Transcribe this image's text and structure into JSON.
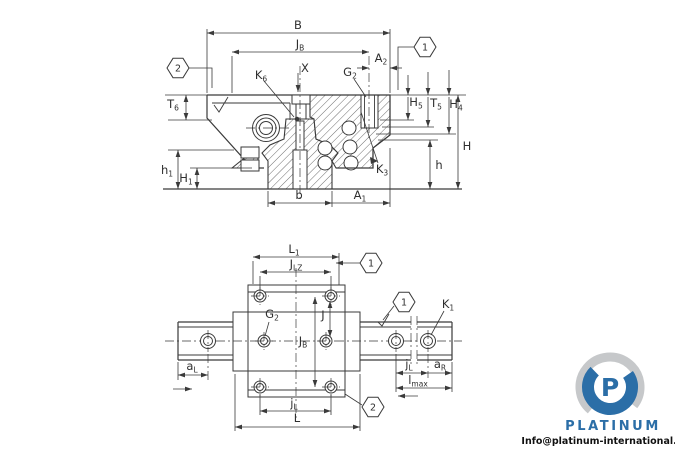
{
  "colors": {
    "line": "#3a3a3a",
    "text": "#2f2f2f",
    "logo_blue": "#2b6ea7",
    "logo_gray": "#c6c8ca"
  },
  "section_view": {
    "dims": {
      "B": {
        "main": "B",
        "sub": ""
      },
      "JB": {
        "main": "J",
        "sub": "B"
      },
      "A2": {
        "main": "A",
        "sub": "2"
      },
      "K6": {
        "main": "K",
        "sub": "6"
      },
      "X": {
        "main": "X",
        "sub": ""
      },
      "G2": {
        "main": "G",
        "sub": "2"
      },
      "T6": {
        "main": "T",
        "sub": "6"
      },
      "H5": {
        "main": "H",
        "sub": "5"
      },
      "T5": {
        "main": "T",
        "sub": "5"
      },
      "H4": {
        "main": "H",
        "sub": "4"
      },
      "H": {
        "main": "H",
        "sub": ""
      },
      "h": {
        "main": "h",
        "sub": ""
      },
      "h1": {
        "main": "h",
        "sub": "1"
      },
      "H1": {
        "main": "H",
        "sub": "1"
      },
      "b": {
        "main": "b",
        "sub": ""
      },
      "A1": {
        "main": "A",
        "sub": "1"
      },
      "K3": {
        "main": "K",
        "sub": "3"
      }
    },
    "balloons": {
      "b1": "1",
      "b2": "2"
    }
  },
  "plan_view": {
    "dims": {
      "L1": {
        "main": "L",
        "sub": "1"
      },
      "JLZ": {
        "main": "J",
        "sub": "LZ"
      },
      "K1": {
        "main": "K",
        "sub": "1"
      },
      "G2": {
        "main": "G",
        "sub": "2"
      },
      "J": {
        "main": "J",
        "sub": ""
      },
      "JB": {
        "main": "J",
        "sub": "B"
      },
      "aL": {
        "main": "a",
        "sub": "L"
      },
      "jLrail": {
        "main": "j",
        "sub": "L"
      },
      "aR": {
        "main": "a",
        "sub": "R"
      },
      "lmax": {
        "main": "l",
        "sub": "max"
      },
      "jL": {
        "main": "j",
        "sub": "L"
      },
      "L": {
        "main": "L",
        "sub": ""
      }
    },
    "balloons": {
      "b1": "1",
      "b2": "2"
    }
  },
  "branding": {
    "logo_letter": "P",
    "logo_text": "PLATINUM",
    "email": "Info@platinum-international.store"
  }
}
